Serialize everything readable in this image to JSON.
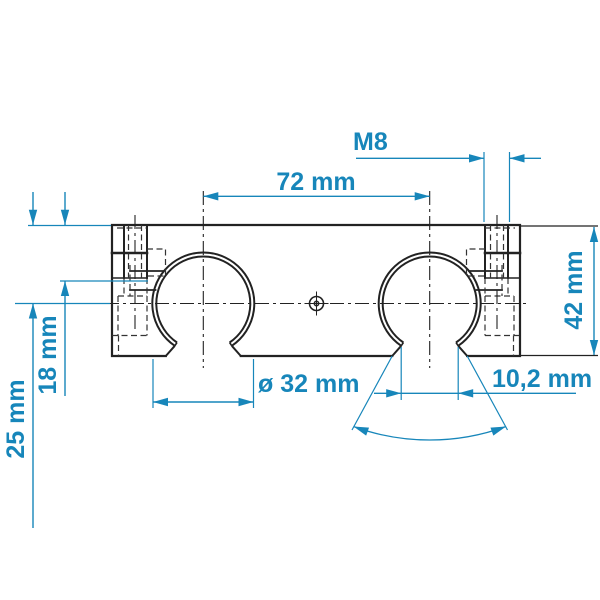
{
  "drawing": {
    "colors": {
      "background": "#ffffff",
      "line": "#222222",
      "hidden_line": "#333333",
      "dimension": "#1786ba"
    },
    "labels": {
      "thread": "M8",
      "hole_spacing": "72 mm",
      "height": "42 mm",
      "bore_diameter": "ø 32 mm",
      "slot_width": "10,2 mm",
      "screw_offset": "18 mm",
      "center_offset": "25 mm"
    }
  }
}
